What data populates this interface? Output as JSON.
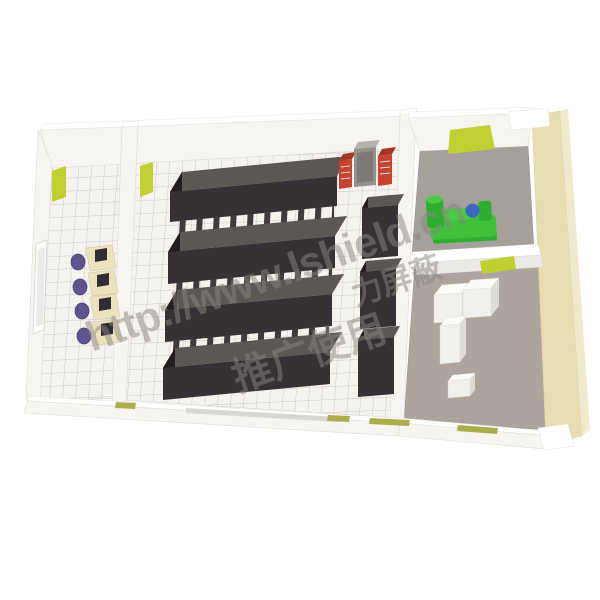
{
  "watermark": {
    "url": "http://www.lshield.cn",
    "cn_line1": "力屏蔽",
    "cn_line2": "推广使用"
  },
  "colors": {
    "accent_green": "#bfd033",
    "olive_green": "#a9af4b",
    "machine_green": "#3fc13a",
    "machine_blue": "#3b66c4",
    "rack_front": "#363134",
    "rack_top": "#5c5755",
    "wall_tan": "#e8ddb0",
    "floor_tile": "#f4f3f0",
    "floor_gray": "#a5a099",
    "ac_red": "#c8432e",
    "desk_cream": "#ece3bd",
    "chair_purple": "#5f5490",
    "watermark_gray": "#8b8680"
  }
}
